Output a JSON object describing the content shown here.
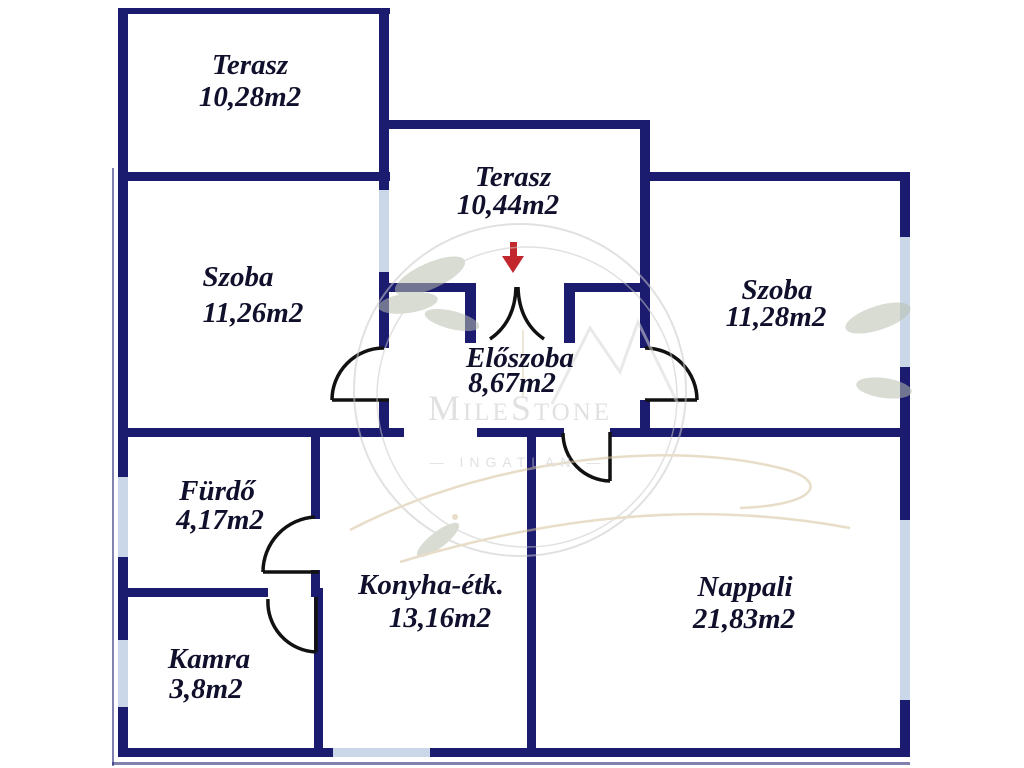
{
  "colors": {
    "wall": "#1b1b6f",
    "window": "#c9d7e8",
    "door": "#111111",
    "text": "#10102c",
    "arrow": "#c1272d",
    "watermark": "#c9c9c9",
    "leaves": "#b9c0b0",
    "gold": "#d5c19b",
    "mountains": "#d8d8d8"
  },
  "watermark": {
    "brand": "MileStone",
    "sub": "— INGATLAN —"
  },
  "entrance": {
    "symbol": "entrance-arrow"
  },
  "rooms": [
    {
      "id": "terasz-upper",
      "name": "Terasz",
      "area": "10,28m2"
    },
    {
      "id": "szoba-left",
      "name": "Szoba",
      "area": "11,26m2"
    },
    {
      "id": "terasz-middle",
      "name": "Terasz",
      "area": "10,44m2"
    },
    {
      "id": "szoba-right",
      "name": "Szoba",
      "area": "11,28m2"
    },
    {
      "id": "eloszoba",
      "name": "Előszoba",
      "area": "8,67m2"
    },
    {
      "id": "furdo",
      "name": "Fürdő",
      "area": "4,17m2"
    },
    {
      "id": "konyha",
      "name": "Konyha-étk.",
      "area": "13,16m2"
    },
    {
      "id": "kamra",
      "name": "Kamra",
      "area": "3,8m2"
    },
    {
      "id": "nappali",
      "name": "Nappali",
      "area": "21,83m2"
    }
  ]
}
